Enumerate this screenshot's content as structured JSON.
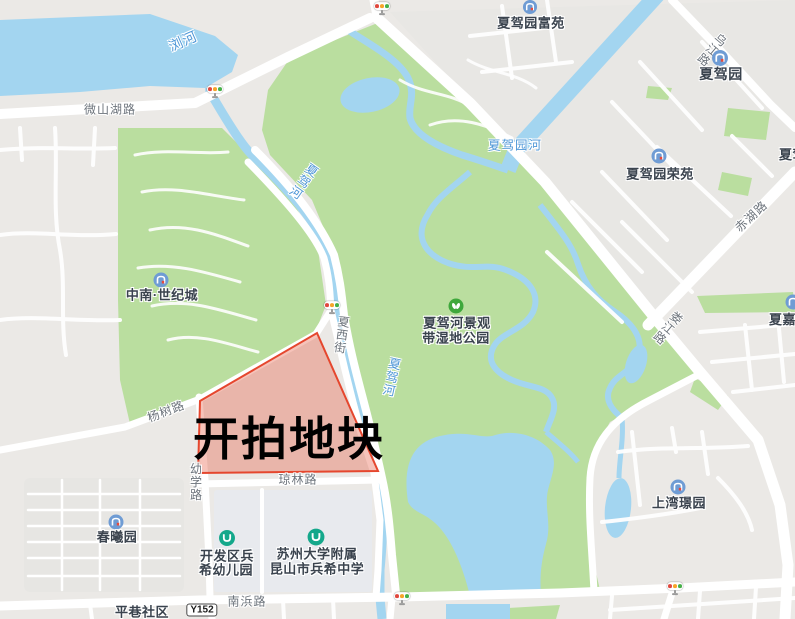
{
  "annotation": {
    "parcel_label": "开拍地块"
  },
  "roads": {
    "weishanhu": "微山湖路",
    "yangshu": "杨树路",
    "youxue": "幼学路",
    "qionglin": "琼林路",
    "xiaxi": "夏西街",
    "nanbang": "南浜路",
    "wujiang": "乌江路",
    "chihu": "赤湖路",
    "loujiang": "娄江路"
  },
  "badges": {
    "y152": "Y152"
  },
  "rivers": {
    "liuhe": "浏河",
    "xiajiahe": "夏驾河",
    "xiajiayuanhe": "夏驾园河"
  },
  "pois": {
    "xiajiayuan_fuyuan": "夏驾园富苑",
    "xiajiayuan": "夏驾园",
    "xiajiayuan_rongyuan": "夏驾园荣苑",
    "zhongnan_shijicheng": "中南·世纪城",
    "wetland_park_line1": "夏驾河景观",
    "wetland_park_line2": "带湿地公园",
    "chunxiyuan": "春曦园",
    "kindergarten_line1": "开发区兵",
    "kindergarten_line2": "希幼儿园",
    "school_line1": "苏州大学附属",
    "school_line2": "昆山市兵希中学",
    "shangwan_jingyuan": "上湾璟园",
    "pingxiang_shequ": "平巷社区",
    "xiajia_cut": "夏嘉",
    "xiajia_right_cut": "夏驾"
  },
  "colors": {
    "background": "#ebe9e6",
    "water": "#a3d5f0",
    "park_green": "#bade9f",
    "district_gray": "#e8e7e4",
    "school_block": "#e8eaee",
    "residential_block": "#e7e6e3",
    "road_fill": "#ffffff",
    "parcel_fill": "rgba(232,96,74,0.38)",
    "parcel_border": "#e5472e",
    "road_label": "#6d747c",
    "river_label": "#4f97d7",
    "poi_label": "#3a434e",
    "residential_icon": "#6f9cd4",
    "park_icon": "#3fa83c",
    "school_icon": "#14a88b",
    "annotation_text": "#000000"
  }
}
